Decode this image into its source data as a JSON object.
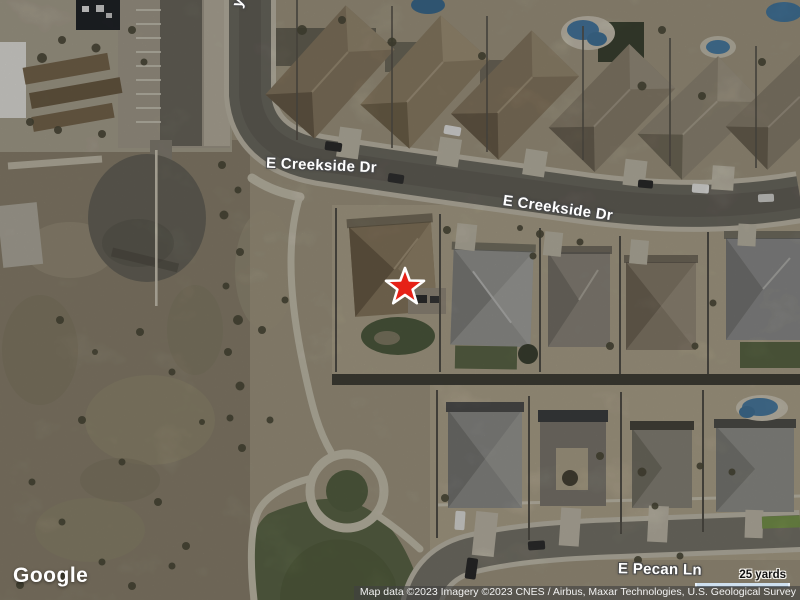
{
  "map": {
    "view_type": "satellite",
    "street_labels": [
      {
        "id": "e-creekside-dr-west",
        "text": "E Creekside Dr"
      },
      {
        "id": "e-creekside-dr-east",
        "text": "E Creekside Dr"
      },
      {
        "id": "e-pecan-ln",
        "text": "E Pecan Ln"
      },
      {
        "id": "partial-street-top",
        "text": "y"
      }
    ],
    "marker": {
      "icon": "star-icon",
      "fill_color": "#e62117",
      "outline_color": "#ffffff"
    },
    "scale": {
      "label": "25 yards"
    },
    "attribution": {
      "text": "Map data ©2023  Imagery ©2023 CNES / Airbus, Maxar Technologies, U.S. Geological Survey"
    },
    "brand": {
      "logo_text": "Google"
    },
    "colors": {
      "terrain_dirt": "#9a9179",
      "park_grass": "#5f6a4a",
      "road_asphalt": "#75726a",
      "curb_light": "#c6c0af",
      "roof_gray": "#9c9c97",
      "roof_brown": "#8b7c64",
      "pool_blue": "#4a7ea6",
      "scale_bar": "#cfe0ef"
    }
  }
}
